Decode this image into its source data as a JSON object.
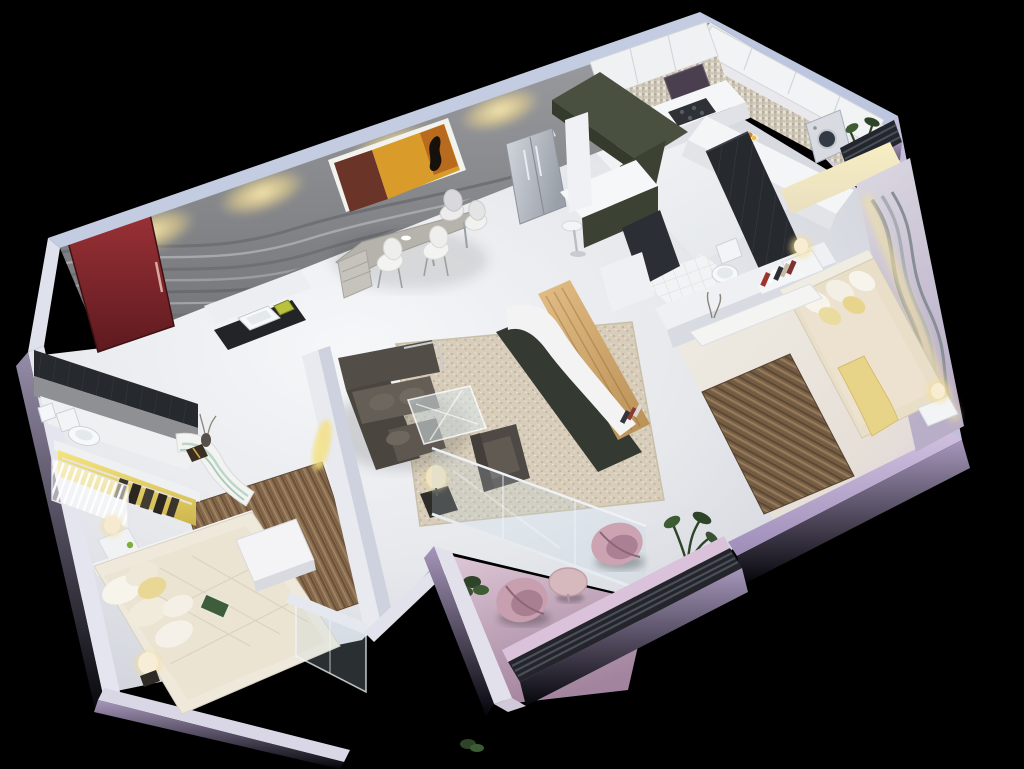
{
  "scene": {
    "description": "3D isometric cutaway render of a 2-bedroom apartment floor plan on a black background",
    "background_color": "#000000",
    "apartment": {
      "rooms": [
        {
          "id": "foyer",
          "name": "entrance-foyer",
          "features": [
            "red-entry-door",
            "wash-basin-vanity",
            "wave-feature-wall",
            "abstract-painting",
            "cove-lighting"
          ]
        },
        {
          "id": "dining-study",
          "name": "dining-study-area",
          "features": [
            "curved-gray-desk",
            "white-shell-chairs"
          ]
        },
        {
          "id": "kitchen",
          "name": "kitchen",
          "features": [
            "stainless-refrigerator",
            "white-upper-cabinets",
            "mosaic-backsplash",
            "gas-cooktop",
            "chimney-hood",
            "olive-pendant-soffit",
            "breakfast-bar",
            "white-bar-stool",
            "fruit-bowl"
          ]
        },
        {
          "id": "utility",
          "name": "utility-balcony",
          "features": [
            "washing-machine",
            "potted-plant",
            "louver-screen"
          ]
        },
        {
          "id": "master-bedroom",
          "name": "master-bedroom",
          "features": [
            "double-bed-cream-bedding",
            "yellow-throw",
            "two-nightstands",
            "glowing-table-lamps",
            "brown-striped-rug",
            "wall-bookshelf",
            "study-ledge",
            "wave-decor-wall",
            "yellow-cove-light"
          ]
        },
        {
          "id": "master-bathroom",
          "name": "master-bathroom",
          "features": [
            "toilet",
            "dark-tile-walls",
            "white-tile-floor",
            "white-half-wall"
          ]
        },
        {
          "id": "living-room",
          "name": "living-room",
          "features": [
            "dark-sectional-sofa",
            "glass-coffee-table",
            "dark-armchair",
            "black-side-table",
            "cream-table-lamp",
            "speckled-beige-rug",
            "wood-tv-panel",
            "white-curved-media-console",
            "glass-wall-to-balcony"
          ]
        },
        {
          "id": "bedroom-2",
          "name": "second-bedroom",
          "features": [
            "double-bed-quilted-spread",
            "pillow-cluster",
            "white-foot-bench",
            "brown-rug",
            "nightstand-lamp",
            "glowing-floor-lamp",
            "open-wardrobe-yellow-light",
            "hanging-clothes",
            "striped-sliding-doors",
            "curved-white-dresser",
            "glass-partition"
          ]
        },
        {
          "id": "bathroom-2",
          "name": "second-bathroom",
          "features": [
            "toilet",
            "dark-tile-wall",
            "cistern"
          ]
        },
        {
          "id": "balcony",
          "name": "balcony",
          "features": [
            "two-petal-chairs",
            "round-side-table",
            "corner-plants",
            "dark-louver-railing",
            "mauve-floor"
          ]
        }
      ]
    },
    "palette": {
      "background": "#000000",
      "wall_top_face": "#c3cce0",
      "feature_wall_gray": "#8d8e92",
      "wave_line_dark": "#6f7075",
      "wave_line_light": "#a7a8ac",
      "cove_glow": "#f2e0a0",
      "door_red": "#8c2a30",
      "painting_amber": "#d99b2a",
      "painting_maroon": "#6b3428",
      "olive_unit": "#3c4233",
      "dark_tile": "#26292e",
      "kitchen_white": "#f2f3f5",
      "fridge_steel": "#b9bec6",
      "floor_main": "#e9eaee",
      "bedding_cream": "#e7ddc9",
      "pillow_yellow": "#e9d48e",
      "rug_brown": "#7d6248",
      "living_rug_beige": "#d7cdba",
      "sofa_taupe": "#4f4a44",
      "wood_panel": "#d3ab71",
      "balcony_mauve": "#c9aabf",
      "chair_mauve": "#c79fae",
      "lavender_wall": "#b4a5c8",
      "glass_tint": "#b9d2da",
      "lamp_glow": "#ffdf9f",
      "wardrobe_yellow": "#f2df7a"
    }
  }
}
